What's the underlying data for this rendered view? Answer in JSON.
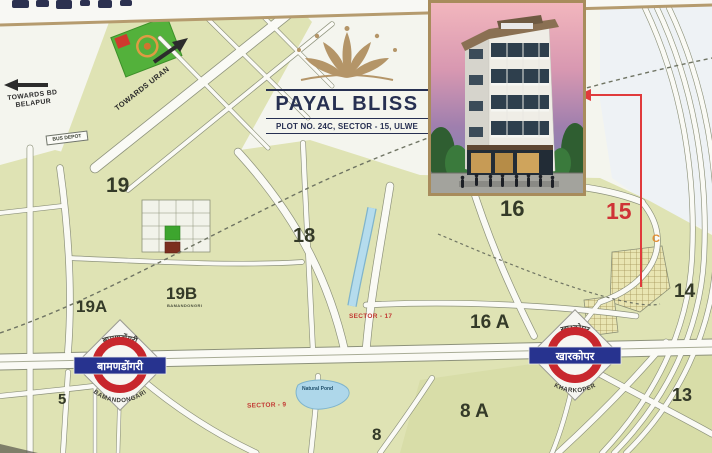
{
  "project": {
    "name": "PAYAL BLISS",
    "address": "PLOT NO. 24C, SECTOR - 15, ULWE"
  },
  "directions": {
    "uran": "TOWARDS URAN",
    "belapur": "TOWARDS BD BELAPUR"
  },
  "stations": {
    "bamandongari": {
      "local": "बामणडोंगरी",
      "latin": "BAMANDONGARI"
    },
    "kharkoper": {
      "local": "खारकोपर",
      "latin": "KHARKOPER"
    }
  },
  "map": {
    "sectors": {
      "s19": "19",
      "s19a": "19A",
      "s19b": "19B",
      "s18": "18",
      "s16": "16",
      "s16a": "16 A",
      "s15": "15",
      "s14": "14",
      "s13": "13",
      "s8": "8",
      "s8a": "8 A",
      "s5": "5",
      "site_plot": "C"
    },
    "tags": {
      "sector17": "SECTOR - 17",
      "sector9": "SECTOR - 9"
    },
    "bus_depot": "BUS DEPOT",
    "pond": "Natural Pond",
    "s19b_caption": "BAMANDONGRI"
  },
  "colors": {
    "gold": "#b49568",
    "navy": "#273052",
    "accent_red": "#cf3336",
    "station_blue": "#27338f",
    "ring_red": "#c8272d",
    "block_green": "#dfe3b4",
    "water_blue": "#b5dced"
  }
}
